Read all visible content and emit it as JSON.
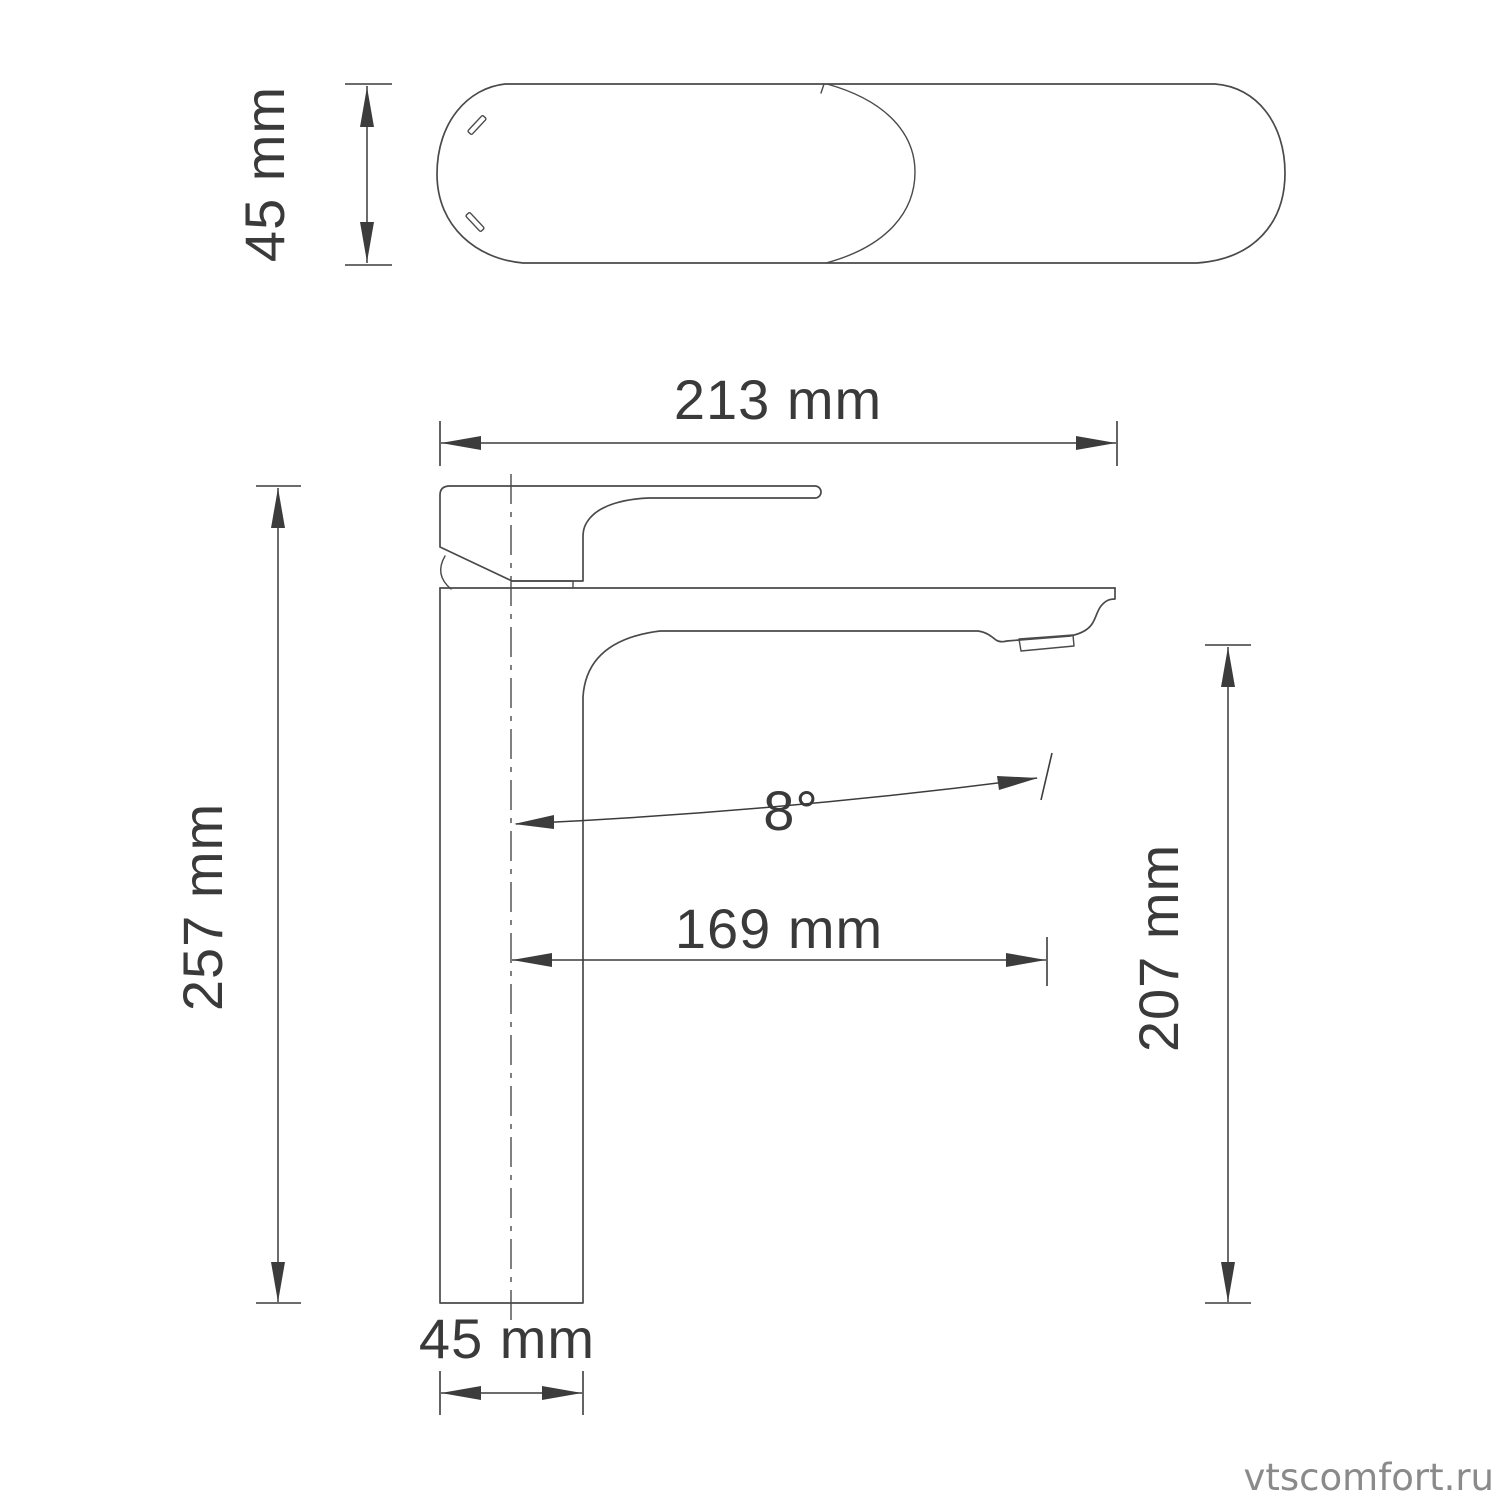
{
  "drawing": {
    "top_view": {
      "height_label": "45 mm"
    },
    "side_view": {
      "overall_width_label": "213 mm",
      "overall_height_label": "257 mm",
      "spout_reach_label": "169 mm",
      "spout_outlet_height_label": "207 mm",
      "spout_angle_label": "8°",
      "base_width_label": "45 mm"
    },
    "watermark": "vtscomfort.ru",
    "colors": {
      "geometry_line": "#4a4a4a",
      "dimension_line": "#3c3c3c",
      "label_text": "#3a3a3a",
      "watermark_text": "#8a8a8a",
      "background": "#ffffff"
    }
  }
}
